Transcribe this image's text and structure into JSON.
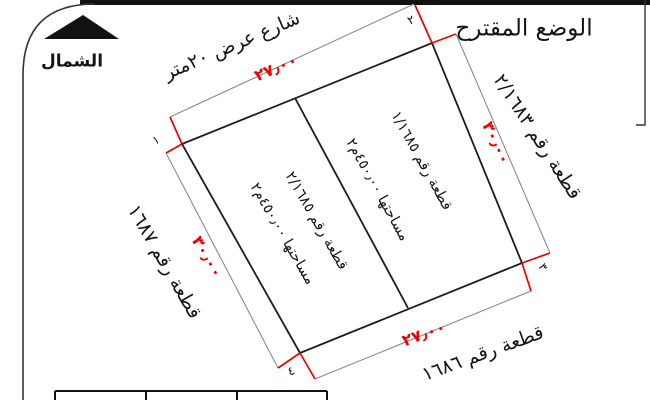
{
  "diagram": {
    "title": "الوضع المقترح",
    "north_label": "الشمال",
    "street_label": "شارع عرض ٢٠متر",
    "neighbors": {
      "right": "قطعة رقم ٢/١٦٨٣",
      "left": "قطعة رقم ١٦٨٧",
      "bottom": "قطعة رقم ١٦٨٦"
    },
    "parcels": {
      "right": {
        "name": "قطعة رقم ١/١٦٨٥",
        "area": "مساحتها ٤٥٠٫٠٠م٢"
      },
      "left": {
        "name": "قطعة رقم ٢/١٦٨٥",
        "area": "مساحتها ٤٥٠٫٠٠م٢"
      }
    },
    "dimensions": {
      "top": "٢٧٫٠٠",
      "bottom": "٢٧٫٠٠",
      "right": "٣٠٫٠٠",
      "left": "٣٠٫٠٠"
    },
    "corners": [
      "١",
      "٢",
      "٣",
      "٤"
    ],
    "colors": {
      "dimension_red": "#ee0000",
      "line_black": "#1c1c1c",
      "dim_line_gray": "#8a8a8a"
    }
  }
}
